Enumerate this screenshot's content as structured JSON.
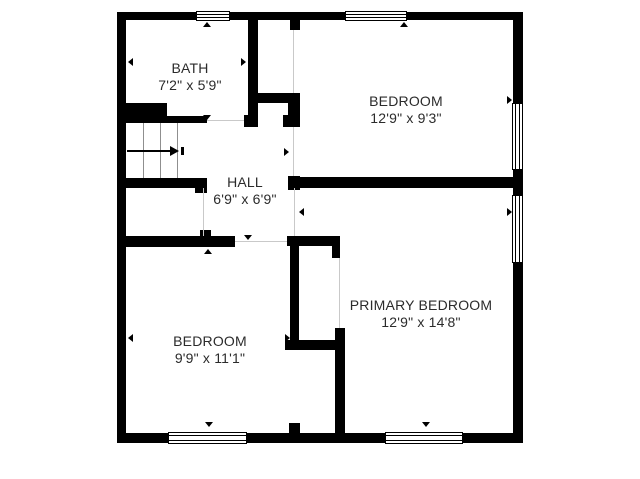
{
  "floorplan": {
    "colors": {
      "wall": "#000000",
      "background": "#ffffff",
      "text": "#2b2b2b",
      "stair_tread": "#8f8f8f",
      "opening_hairline": "#c9c9c9"
    },
    "rooms": [
      {
        "key": "bath",
        "name": "BATH",
        "dimensions": "7'2\" x 5'9\""
      },
      {
        "key": "bedroom-top-right",
        "name": "BEDROOM",
        "dimensions": "12'9\" x 9'3\""
      },
      {
        "key": "hall",
        "name": "HALL",
        "dimensions": "6'9\" x 6'9\""
      },
      {
        "key": "bedroom-bottom-left",
        "name": "BEDROOM",
        "dimensions": "9'9\" x 11'1\""
      },
      {
        "key": "primary-bedroom",
        "name": "PRIMARY BEDROOM",
        "dimensions": "12'9\" x 14'8\""
      }
    ],
    "markers": [
      {
        "name": "opening-marker",
        "dir": "up",
        "x": 207,
        "y": 24
      },
      {
        "name": "opening-marker",
        "dir": "up",
        "x": 404,
        "y": 24
      },
      {
        "name": "opening-marker",
        "dir": "left",
        "x": 130,
        "y": 62
      },
      {
        "name": "opening-marker",
        "dir": "right",
        "x": 243,
        "y": 62
      },
      {
        "name": "opening-marker",
        "dir": "down",
        "x": 207,
        "y": 117
      },
      {
        "name": "opening-marker",
        "dir": "right",
        "x": 286,
        "y": 152
      },
      {
        "name": "opening-marker",
        "dir": "right",
        "x": 509,
        "y": 100
      },
      {
        "name": "opening-marker",
        "dir": "down",
        "x": 405,
        "y": 180
      },
      {
        "name": "opening-marker",
        "dir": "down",
        "x": 248,
        "y": 237
      },
      {
        "name": "opening-marker",
        "dir": "up",
        "x": 208,
        "y": 251
      },
      {
        "name": "opening-marker",
        "dir": "left",
        "x": 301,
        "y": 212
      },
      {
        "name": "opening-marker",
        "dir": "right",
        "x": 509,
        "y": 212
      },
      {
        "name": "opening-marker",
        "dir": "left",
        "x": 130,
        "y": 338
      },
      {
        "name": "opening-marker",
        "dir": "right",
        "x": 287,
        "y": 338
      },
      {
        "name": "opening-marker",
        "dir": "down",
        "x": 209,
        "y": 424
      },
      {
        "name": "opening-marker",
        "dir": "down",
        "x": 426,
        "y": 424
      }
    ]
  }
}
